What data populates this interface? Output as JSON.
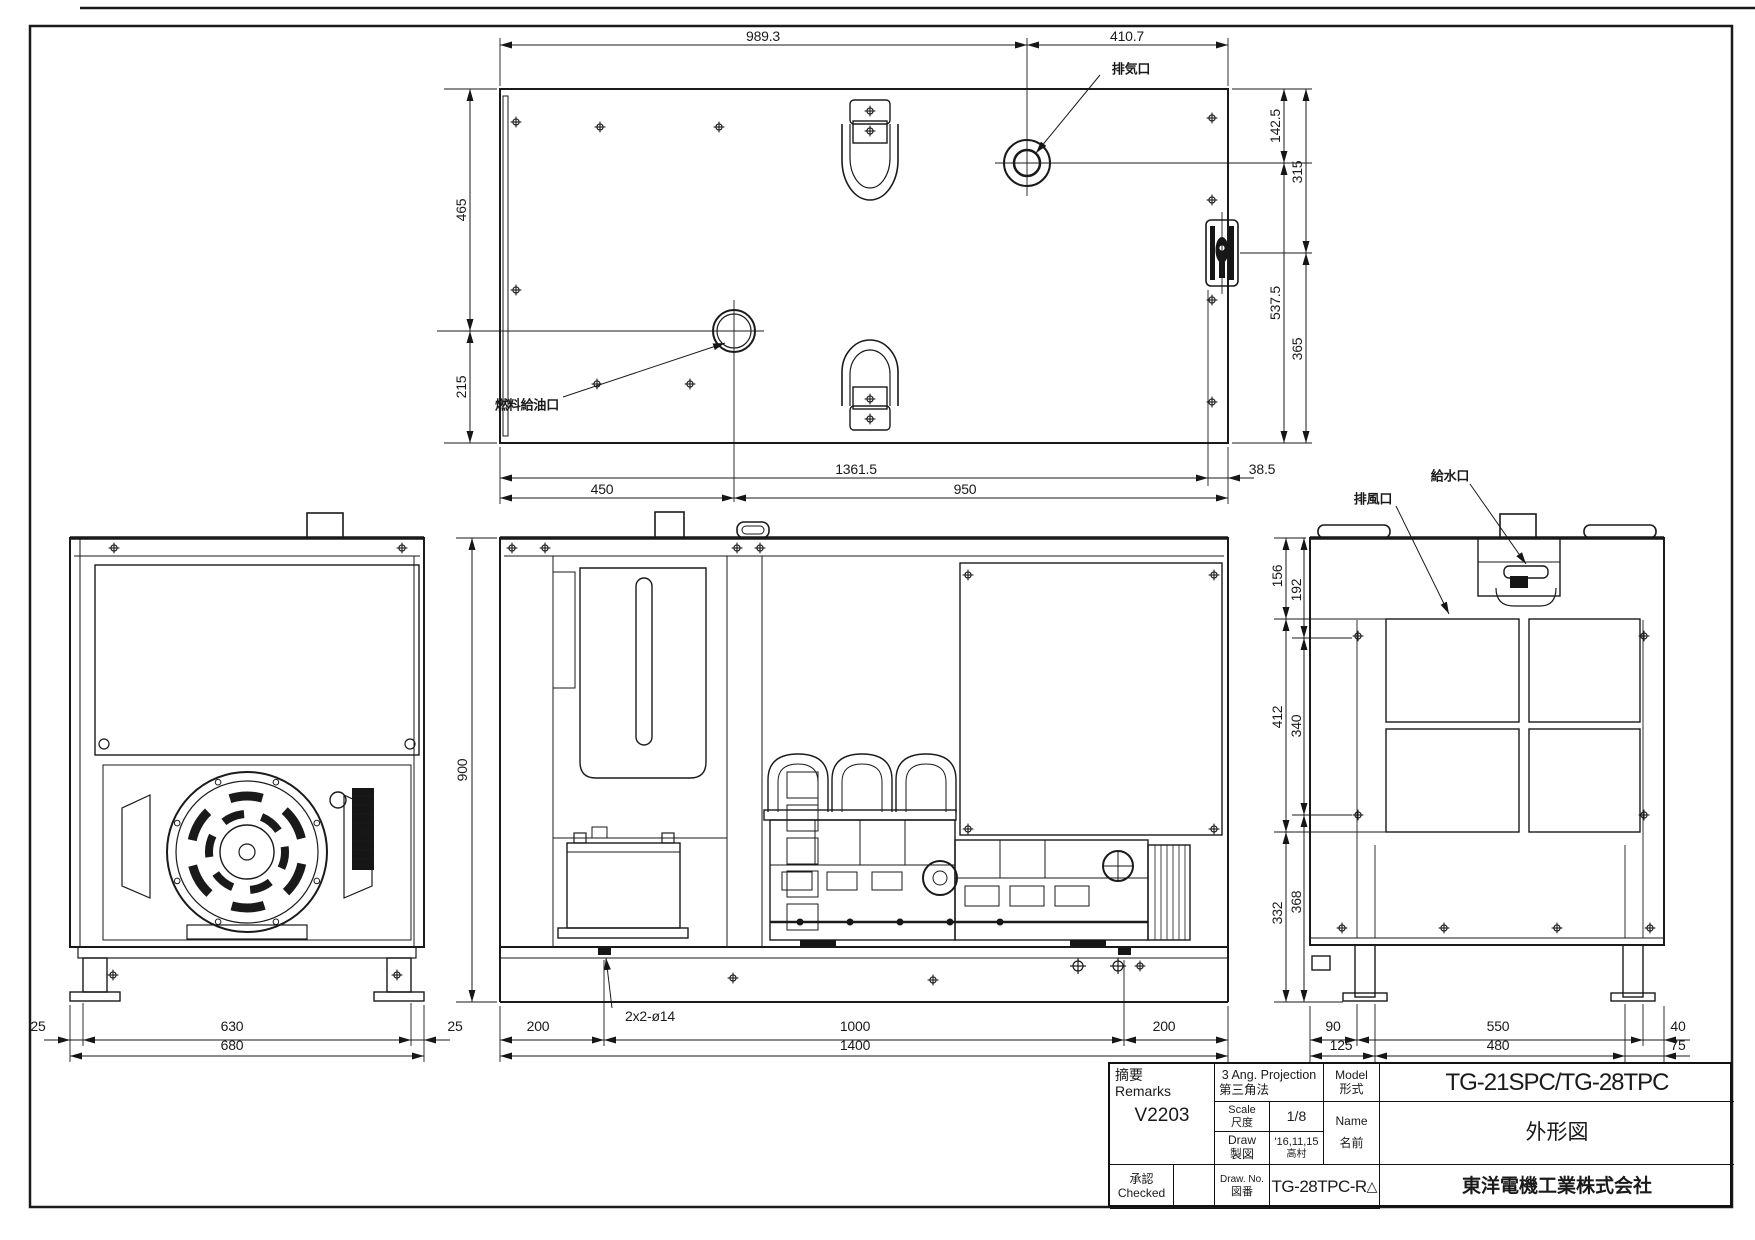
{
  "top_view": {
    "label_exhaust": "排気口",
    "label_fuel": "燃料給油口",
    "dim_top_left": "989.3",
    "dim_top_right": "410.7",
    "dim_left_upper": "465",
    "dim_left_lower": "215",
    "dim_right_inner_top": "142.5",
    "dim_right_outer_top": "315",
    "dim_right_inner_bottom": "537.5",
    "dim_right_outer_bottom": "365",
    "dim_bottom_span": "1361.5",
    "dim_bottom_offset": "38.5",
    "dim_bottom_left": "450",
    "dim_bottom_right": "950"
  },
  "front_view": {
    "dim_left": "25",
    "dim_center": "630",
    "dim_right": "25",
    "dim_overall": "680"
  },
  "side_view": {
    "dim_height": "900",
    "dim_base_left": "200",
    "dim_base_center": "1000",
    "dim_base_right": "200",
    "dim_overall": "1400",
    "label_holes": "2x2-ø14"
  },
  "rear_view": {
    "label_air_outlet": "排風口",
    "label_water_inlet": "給水口",
    "dim_l1_inner": "156",
    "dim_l1_outer": "192",
    "dim_l2_inner": "412",
    "dim_l2_outer": "340",
    "dim_l3_inner": "332",
    "dim_l3_outer": "368",
    "dim_b_outer_left": "90",
    "dim_b_outer_center": "550",
    "dim_b_outer_right": "40",
    "dim_b_inner_left": "125",
    "dim_b_inner_center": "480",
    "dim_b_inner_right": "75"
  },
  "title_block": {
    "remarks_jp": "摘要",
    "remarks_en": "Remarks",
    "remarks_value": "V2203",
    "projection_en": "3 Ang. Projection",
    "projection_jp": "第三角法",
    "scale_en": "Scale",
    "scale_jp": "尺度",
    "scale_value": "1/8",
    "draw_en": "Draw",
    "draw_jp": "製図",
    "draw_date": "'16,11,15",
    "draw_author": "高村",
    "model_en": "Model",
    "model_jp": "形式",
    "model_value": "TG-21SPC/TG-28TPC",
    "name_en": "Name",
    "name_jp": "名前",
    "name_value": "外形図",
    "checked_jp": "承認",
    "checked_en": "Checked",
    "drawno_en": "Draw. No.",
    "drawno_jp": "図番",
    "drawno_value": "TG-28TPC-R",
    "drawno_rev": "△",
    "company": "東洋電機工業株式会社"
  }
}
